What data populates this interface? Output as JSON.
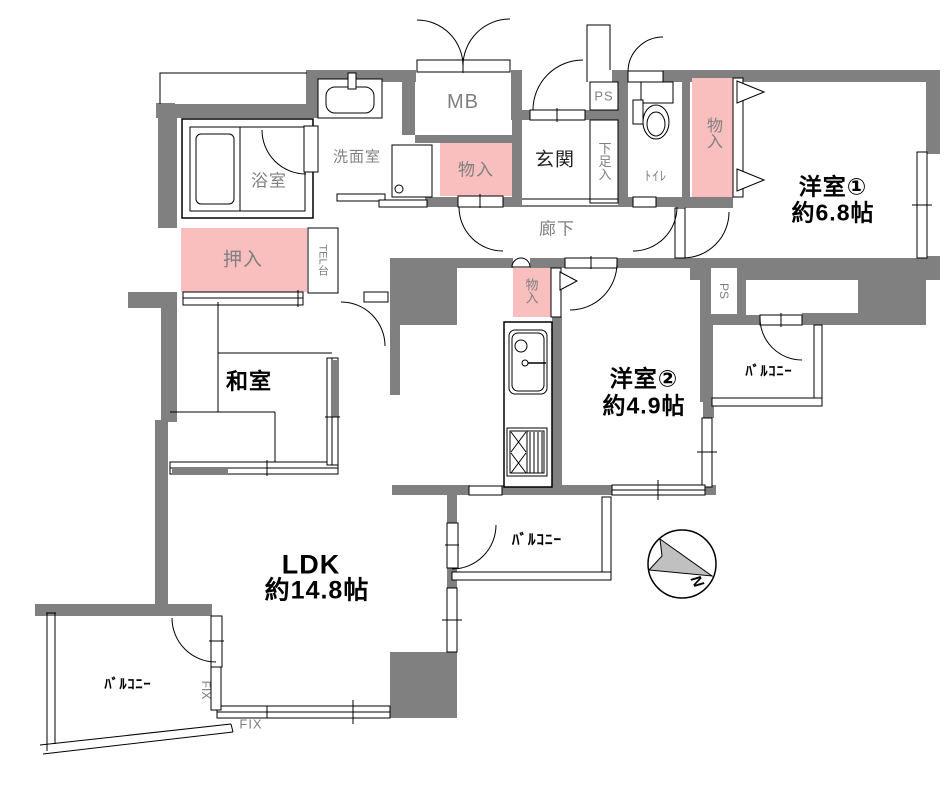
{
  "plan_type": "apartment-floor-plan",
  "colors": {
    "wall": "#808080",
    "closet_pink": "#F9BEBE",
    "label_gray": "#808080",
    "room_text": "#000000",
    "compass_fill": "#C0C0C0"
  },
  "rooms": [
    {
      "name": "洋室①",
      "size": "約6.8帖"
    },
    {
      "name": "洋室②",
      "size": "約4.9帖"
    },
    {
      "name": "LDK",
      "size": "約14.8帖"
    },
    {
      "name": "和室",
      "size": ""
    },
    {
      "name": "玄関",
      "size": ""
    },
    {
      "name": "廊下",
      "size": ""
    },
    {
      "name": "浴室",
      "size": ""
    },
    {
      "name": "洗面室",
      "size": ""
    },
    {
      "name": "ﾄｲﾚ",
      "size": ""
    }
  ],
  "labels": {
    "bath": "浴室",
    "washroom": "洗面室",
    "mb": "MB",
    "storage1": "物入",
    "entrance": "玄関",
    "ps1": "PS",
    "shoe": "下足入",
    "toilet": "ﾄｲﾚ",
    "storage2": "物入",
    "room1_name": "洋室①",
    "room1_size": "約6.8帖",
    "hallway": "廊下",
    "oshiire": "押入",
    "tel": "TEL台",
    "washitsu": "和室",
    "storage3": "物入",
    "room2_name": "洋室②",
    "room2_size": "約4.9帖",
    "ps2": "PS",
    "balcony1": "ﾊﾞﾙｺﾆｰ",
    "ldk_name": "LDK",
    "ldk_size": "約14.8帖",
    "balcony2": "ﾊﾞﾙｺﾆｰ",
    "balcony3": "ﾊﾞﾙｺﾆｰ",
    "fix1": "FIX",
    "fix2": "FIX",
    "north": "N"
  }
}
